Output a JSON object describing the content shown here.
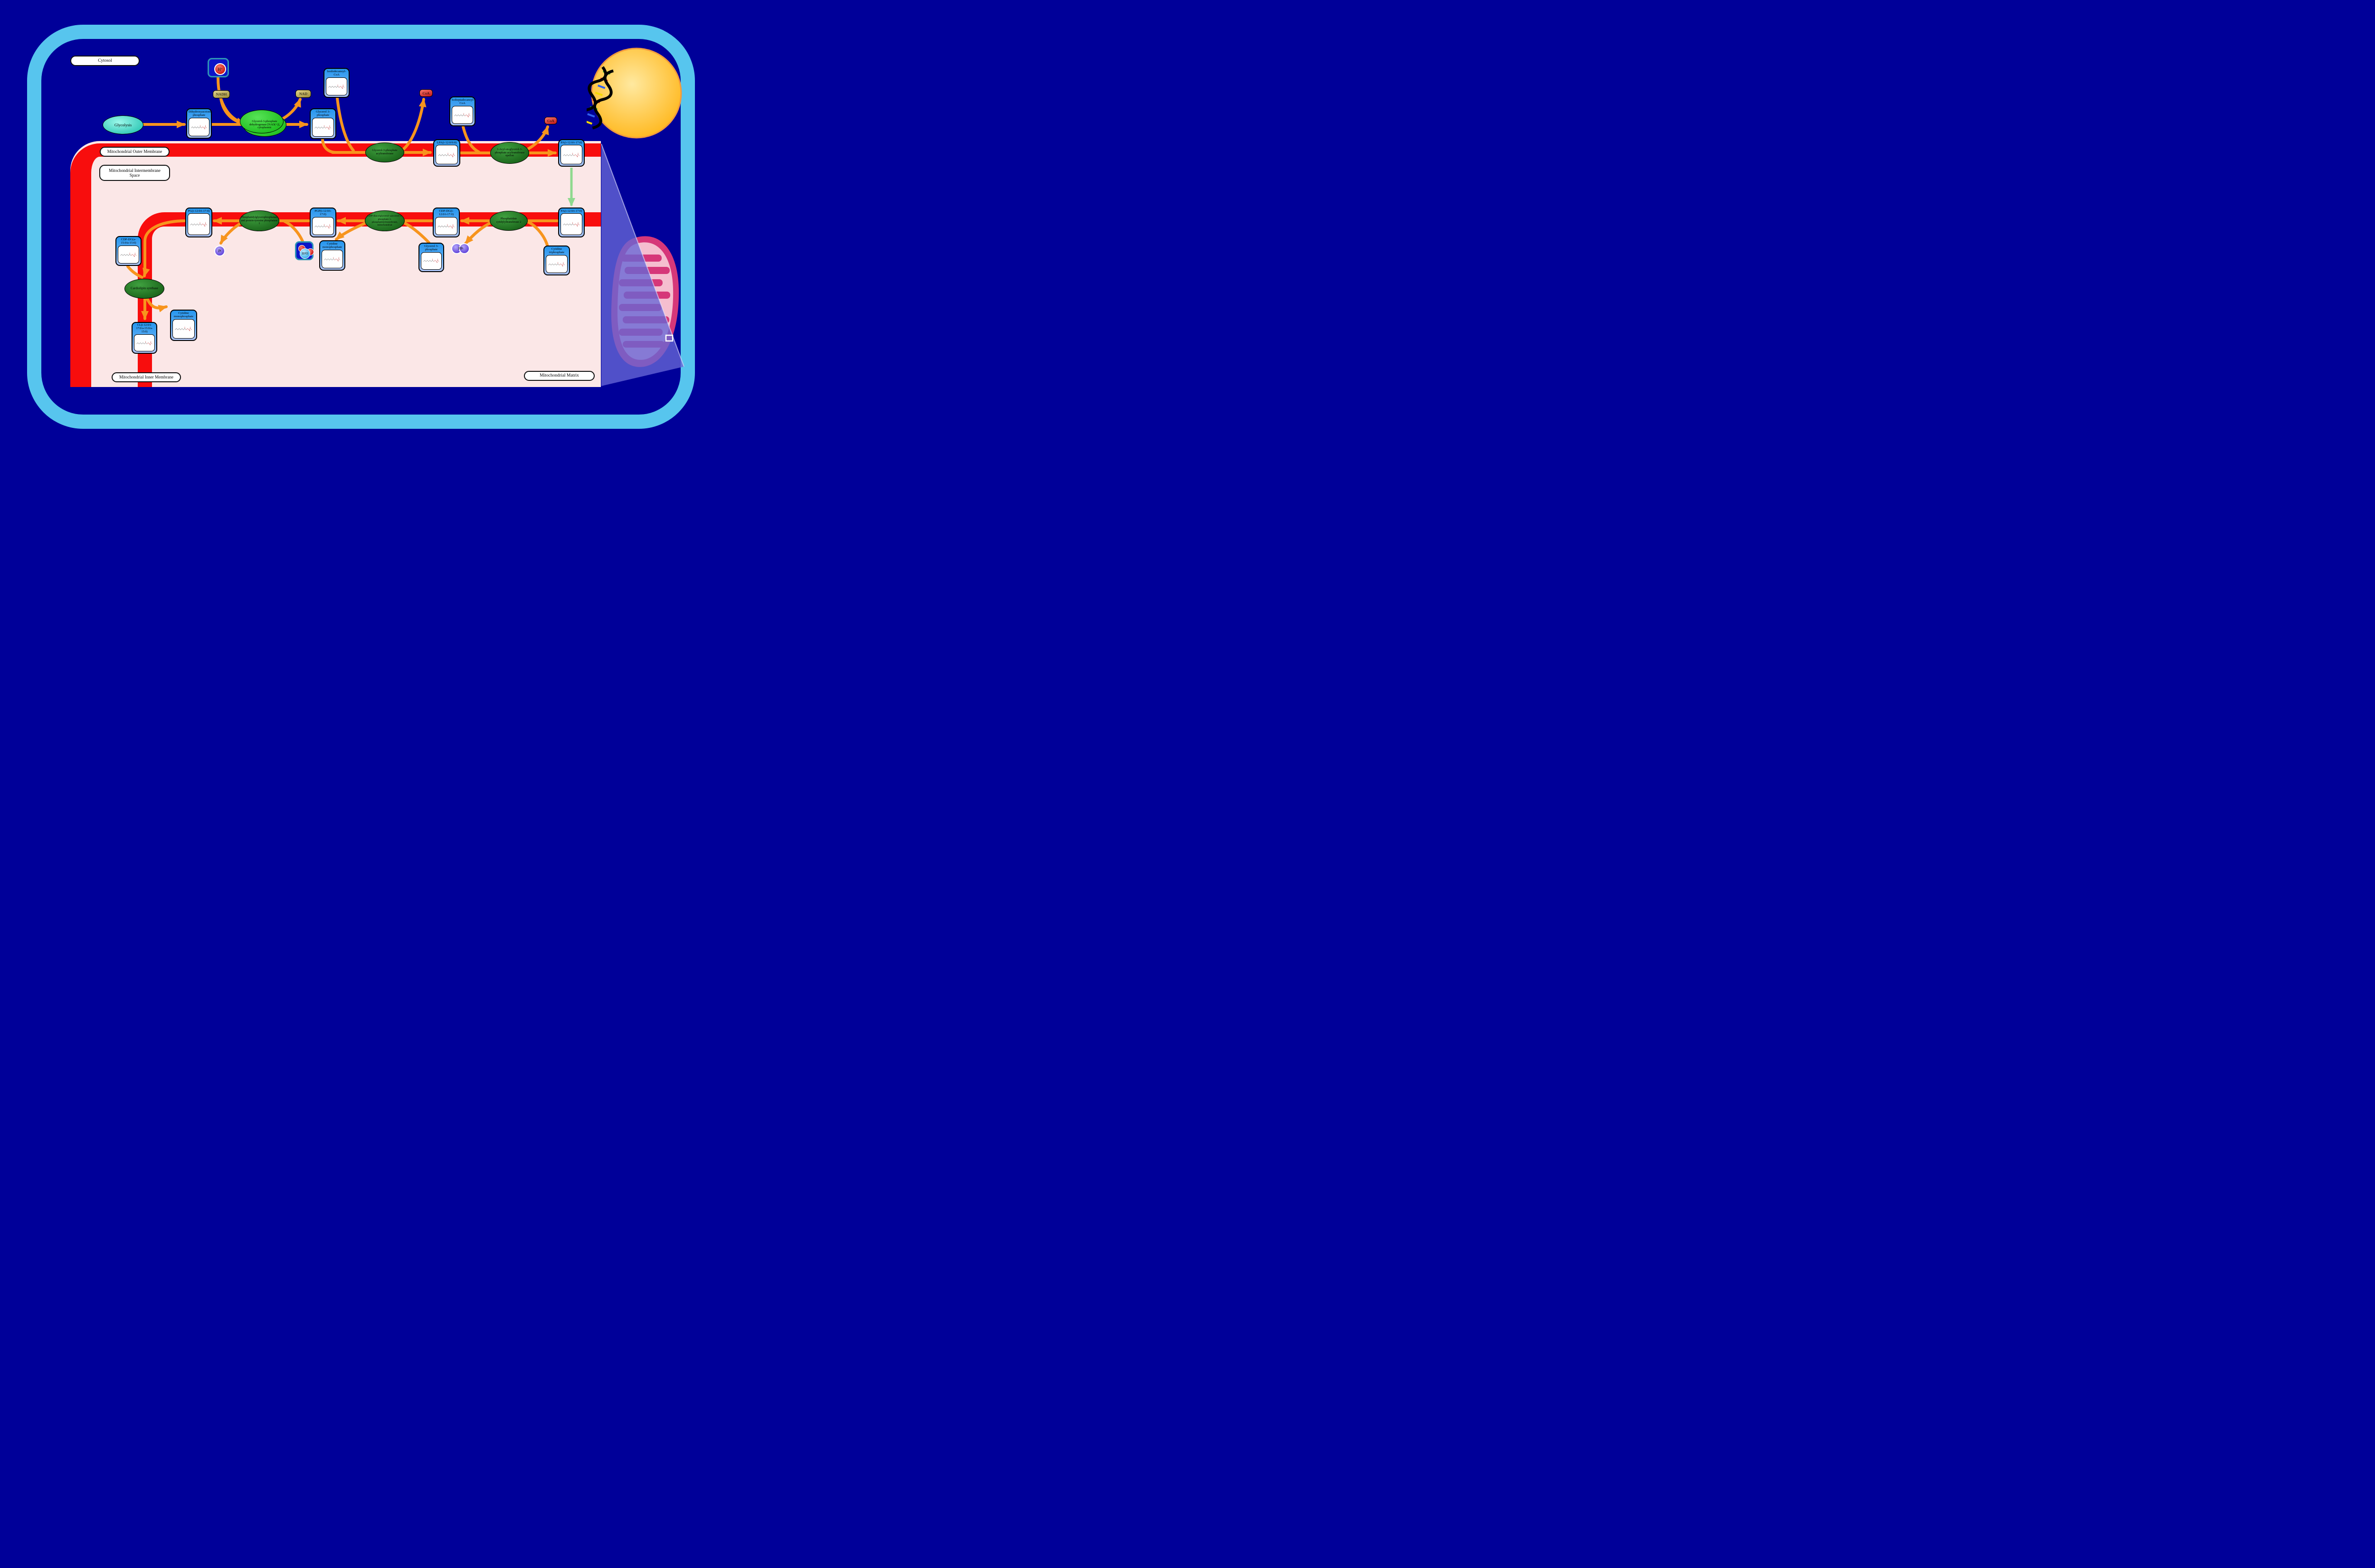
{
  "compartments": {
    "cytosol": "Cytosol",
    "outer_membrane": "Mitochondrial Outer Membrane",
    "intermembrane_space": "Mitochondrial Intermembrane Space",
    "inner_membrane": "Mitochondrial Inner Membrane",
    "matrix": "Mitochondrial Matrix"
  },
  "nodes": {
    "glycolysis": "Glycolysis"
  },
  "enzymes": {
    "gpd1": "Glycerol-3-phosphate dehydrogenase [NAD(+)], cytoplasmic",
    "gpat": "Glycerol-3-phosphate acyltransferase",
    "agpat": "1-Acyl-sn-glycerol-3-phosphate acyltransferase epsilon",
    "cds2": "Phosphatidate cytidylyltransferase 2",
    "pgs1": "CDP-diacylglycerol--glycerol-3-phosphate 3-phosphatidyltransferase, mitochondrial",
    "ptpmt1": "Phosphatidylglycerophosphatase and protein-tyrosine phosphatase 1",
    "crls1": "Cardiolipin synthase"
  },
  "metabolites": {
    "dhap": "Dihydroxyacetone phosphate",
    "g3p_cytosol": "Glycerol 3-phosphate",
    "isododecanoyl_coa": "Isododecanoyl-CoA",
    "isoheptadecanoyl_coa": "Isoheptadecanoyl-CoA",
    "lpa": "LPA(i-12:0/0:0)",
    "pa_outer": "PA(i-12:0/i-17:0)",
    "pa_inner": "PA(i-12:0/i-17:0)",
    "cdp_dg_1": "CDP-DG(i-12:0/i-17:0)",
    "pgp": "PGP(i-12:0/i-17:0)",
    "pg": "PG(i-12:0/i-17:0)",
    "ctp": "Cytidine triphosphate",
    "g3p_matrix": "Glycerol 3-phosphate",
    "cmp_matrix": "Cytidine monophosphate",
    "cdp_dg_2": "CDP-DG(a-15:0/a-15:0)",
    "cl": "CL(i-12:0/i-17:0/a-15:0/a-15:0)",
    "cmp_cl": "Cytidine monophosphate"
  },
  "cofactors": {
    "h_plus": {
      "symbol": "H",
      "charge": "+"
    },
    "nadh": "NADH",
    "nad": "NAD",
    "coa_released_1": "CoA",
    "coa_released_2": "CoA",
    "h2o": {
      "h": "H",
      "sub": "2",
      "o": "O"
    },
    "pi": {
      "main": "P",
      "sub": "i"
    },
    "ppi": {
      "main": "PP",
      "sub": "i"
    }
  },
  "colors": {
    "background": "#000099",
    "cell_membrane": "#57C5EE",
    "organelle_membrane_red": "#F80D0D",
    "matrix_pink": "#FBE7E7",
    "arrow_orange": "#F7941D",
    "transport_arrow_green": "#8FD98F",
    "metabolite_header_blue": "#2596EF",
    "enzyme_green_dark": "#1A641A",
    "enzyme_green_bright": "#1DBE1D",
    "glycolysis_teal": "#27C4B2",
    "nucleus_yellow": "#FFC125",
    "mitochondrion_pink": "#D63779"
  }
}
